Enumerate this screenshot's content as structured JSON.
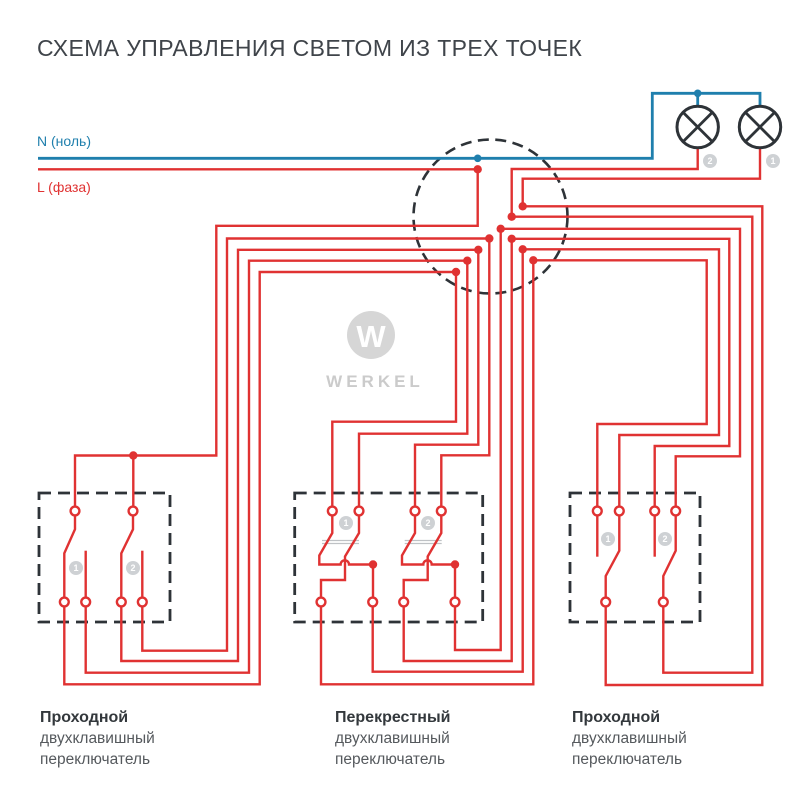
{
  "title": "СХЕМА УПРАВЛЕНИЯ СВЕТОМ ИЗ ТРЕХ ТОЧЕК",
  "legend": {
    "neutral_label": "N (ноль)",
    "phase_label": "L (фаза)"
  },
  "lamps": [
    {
      "number": "2"
    },
    {
      "number": "1"
    }
  ],
  "logo": {
    "monogram": "W",
    "wordmark": "WERKEL"
  },
  "switches": [
    {
      "badges": [
        "1",
        "2"
      ],
      "name": "Проходной",
      "line2": "двухклавишный",
      "line3": "переключатель"
    },
    {
      "badges": [
        "1",
        "2"
      ],
      "name": "Перекрестный",
      "line2": "двухклавишный",
      "line3": "переключатель"
    },
    {
      "badges": [
        "1",
        "2"
      ],
      "name": "Проходной",
      "line2": "двухклавишный",
      "line3": "переключатель"
    }
  ],
  "colors": {
    "wire_phase": "#e03232",
    "wire_neutral": "#1f7fad",
    "outline": "#2e3338",
    "badge_bg": "#ced1d4",
    "badge_text": "#ffffff",
    "logo_gray": "#d6d6d6",
    "logo_text": "#cbcbcb",
    "title_color": "#3f444a",
    "label_dark": "#33383c",
    "label_gray": "#55595d"
  }
}
